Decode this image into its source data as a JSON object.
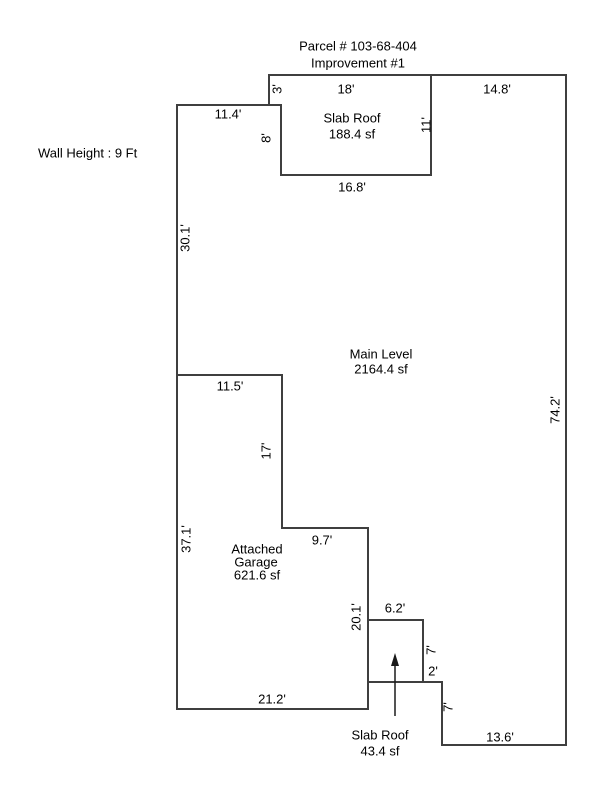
{
  "header": {
    "parcel_title": "Parcel # 103-68-404",
    "improvement_title": "Improvement #1"
  },
  "annotations": {
    "wall_height": "Wall Height : 9 Ft"
  },
  "areas": {
    "slab_roof_top": {
      "name": "Slab Roof",
      "area": "188.4 sf"
    },
    "main_level": {
      "name": "Main Level",
      "area": "2164.4 sf"
    },
    "attached_garage": {
      "name_line1": "Attached",
      "name_line2": "Garage",
      "area": "621.6 sf"
    },
    "slab_roof_bottom": {
      "name": "Slab Roof",
      "area": "43.4 sf"
    }
  },
  "dimensions": {
    "top_slab_width": "18'",
    "top_right_width": "14.8'",
    "top_notch_height": "3'",
    "upper_left_width": "11.4'",
    "slab_left_height": "8'",
    "slab_right_height": "11'",
    "slab_bottom_width": "16.8'",
    "left_upper_height": "30.1'",
    "right_side_height": "74.2'",
    "garage_top_width": "11.5'",
    "garage_inner_height": "17'",
    "left_lower_height": "37.1'",
    "garage_step_width": "9.7'",
    "garage_right_height": "20.1'",
    "porch_top_width": "6.2'",
    "porch_right_height": "7'",
    "porch_step_width": "2'",
    "garage_bottom_width": "21.2'",
    "lower_right_step_height": "7'",
    "bottom_right_width": "13.6'"
  }
}
